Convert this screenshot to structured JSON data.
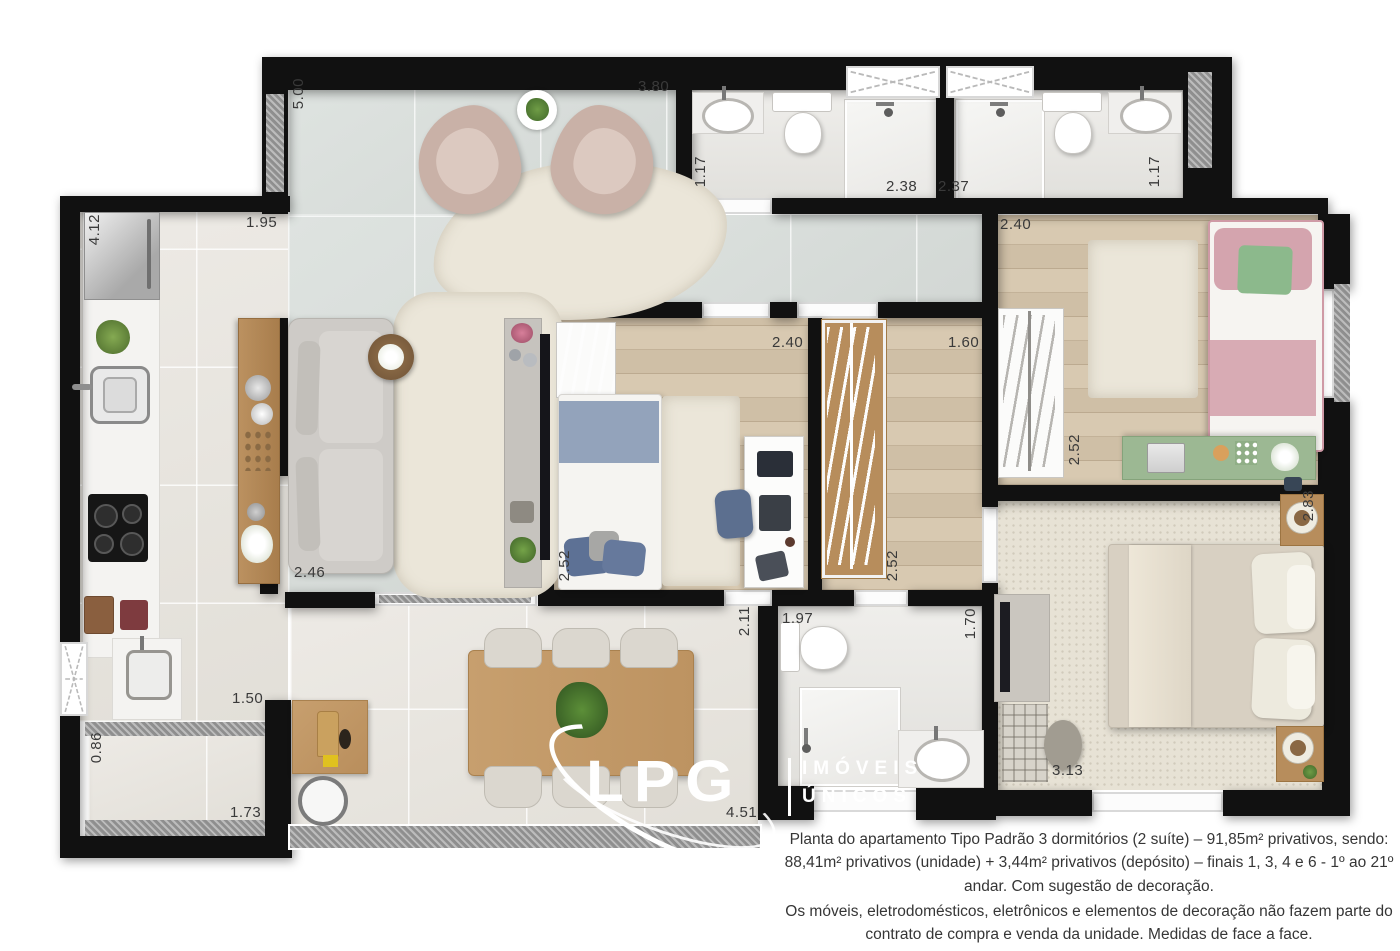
{
  "meta": {
    "title": "Planta do apartamento Tipo Padrão 3 dormitórios",
    "type": "architectural floor plan marketing image"
  },
  "logo": {
    "name": "LPG",
    "tagline_line1": "IMÓVEIS",
    "tagline_line2": "ÚNICOS"
  },
  "caption": {
    "p1": "Planta do apartamento Tipo Padrão 3 dormitórios (2 suíte) – 91,85m² privativos, sendo: 88,41m² privativos (unidade) + 3,44m² privativos (depósito) – finais 1, 3, 4 e 6 - 1º ao 21º andar. Com sugestão de decoração.",
    "p2": "Os móveis, eletrodomésticos, eletrônicos e elementos de decoração não fazem parte do contrato de compra e venda da unidade. Medidas de face a face."
  },
  "dims": {
    "terrace_depth": "5.00",
    "terrace_width": "3.80",
    "bath1_width": "1.17",
    "bath1_length": "2.38",
    "bath2_length": "2.37",
    "bath2_width": "1.17",
    "kitchen_length": "4.12",
    "kitchen_width": "1.95",
    "hall_width": "2.40",
    "bedroom2_width": "2.40",
    "closet_width": "1.60",
    "bedroom3_wardrobe": "2.52",
    "bedroom2_depth": "2.52",
    "closet_depth": "2.52",
    "living_width": "2.46",
    "suite_depth": "2.83",
    "corridor_depth": "2.11",
    "suitebath_width": "1.97",
    "suitebath_depth": "1.70",
    "service_width": "1.50",
    "storage_width": "0.86",
    "storage_length": "1.73",
    "suite_width": "3.13",
    "dining_width": "4.51"
  },
  "colors": {
    "wall": "#111111",
    "tile_floor": "#d9dedb",
    "wood_floor": "#d4c5ad",
    "dining_floor": "#e8e5df",
    "carpet": "#e7e2d5",
    "accent_pink": "#d4a4ae",
    "accent_blue": "#93a3bb",
    "accent_green": "#9cb893",
    "furniture_wood": "#c79f6e"
  }
}
